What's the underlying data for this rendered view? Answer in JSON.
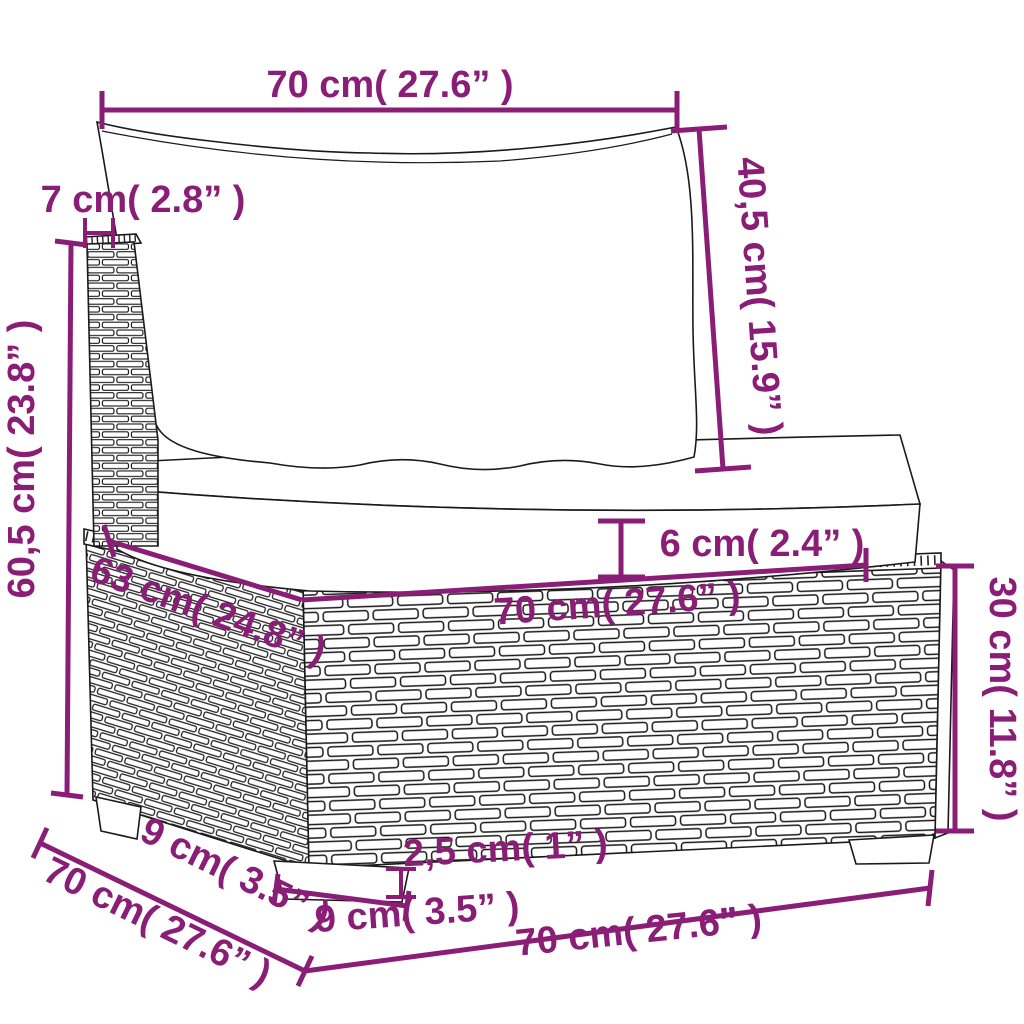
{
  "diagram": {
    "subject": "poly-rattan sofa middle section dimension drawing",
    "background_color": "#ffffff",
    "outline_color": "#1a1a1a",
    "dimension_color": "#8A1E76",
    "dimensions": {
      "pillow_width": {
        "label": "70 cm( 27.6” )"
      },
      "back_cushion_height": {
        "label": "40,5 cm( 15.9” )"
      },
      "backrest_thickness": {
        "label": "7 cm( 2.8” )"
      },
      "total_height": {
        "label": "60,5 cm( 23.8” )"
      },
      "seat_cushion_thickness": {
        "label": "6 cm( 2.4” )"
      },
      "seat_depth": {
        "label": "63 cm( 24.8” )"
      },
      "seat_width": {
        "label": "70 cm( 27.6” )"
      },
      "base_height": {
        "label": "30 cm( 11.8” )"
      },
      "foot_height": {
        "label": "2,5 cm( 1” )"
      },
      "foot_width": {
        "label": "9 cm( 3.5” )"
      },
      "foot_depth": {
        "label": "9 cm( 3.5” )"
      },
      "total_depth": {
        "label": "70 cm( 27.6” )"
      },
      "base_width": {
        "label": "70 cm( 27.6” )"
      }
    }
  }
}
